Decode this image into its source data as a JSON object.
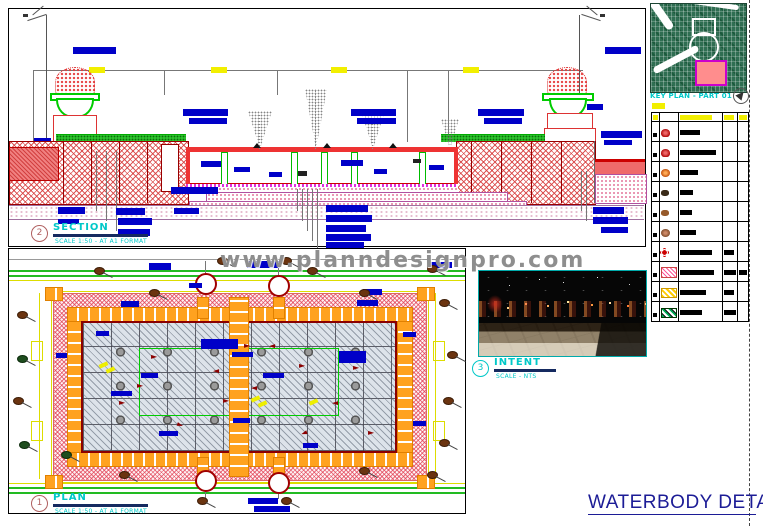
{
  "watermark": "www.planndesignpro.com",
  "sheet_title": "WATERBODY DETAIL",
  "callouts": {
    "section": {
      "number": "2",
      "label": "SECTION",
      "sublabel": "SCALE 1:50  -  AT A1 FORMAT"
    },
    "plan": {
      "number": "1",
      "label": "PLAN",
      "sublabel": "SCALE 1:50  -  AT A1 FORMAT"
    },
    "intent": {
      "number": "3",
      "label": "INTENT",
      "sublabel": "SCALE - NTS"
    }
  },
  "keyplan": {
    "label": "KEY PLAN - PART 01"
  },
  "legend": {
    "rows": [
      {
        "symbol": "tree-red",
        "desc_w": 20
      },
      {
        "symbol": "tree-red",
        "desc_w": 36
      },
      {
        "symbol": "tree-orange",
        "desc_w": 18
      },
      {
        "symbol": "shrub-dark",
        "desc_w": 13
      },
      {
        "symbol": "shrub-brown",
        "desc_w": 12
      },
      {
        "symbol": "tree-brown",
        "desc_w": 16
      },
      {
        "symbol": "flower-red",
        "desc_w": 32,
        "c4_w": 10
      },
      {
        "symbol": "hatch-pink",
        "desc_w": 34,
        "c4_w": 12,
        "c5_w": 8,
        "h": 12
      },
      {
        "symbol": "hatch-yellow",
        "desc_w": 26,
        "c4_w": 10,
        "h": 10
      },
      {
        "symbol": "checker-green",
        "desc_w": 22,
        "c4_w": 12,
        "h": 10
      }
    ]
  },
  "colors": {
    "annotation_blue": "#0000c8",
    "label_cyan": "#00c8c8",
    "title_navy": "#1c1c96",
    "hatch_red": "#d23c3c",
    "paver_orange": "#ffa21f",
    "grass_green": "#2cc22c",
    "keyplan_green": "#2f6e52"
  }
}
